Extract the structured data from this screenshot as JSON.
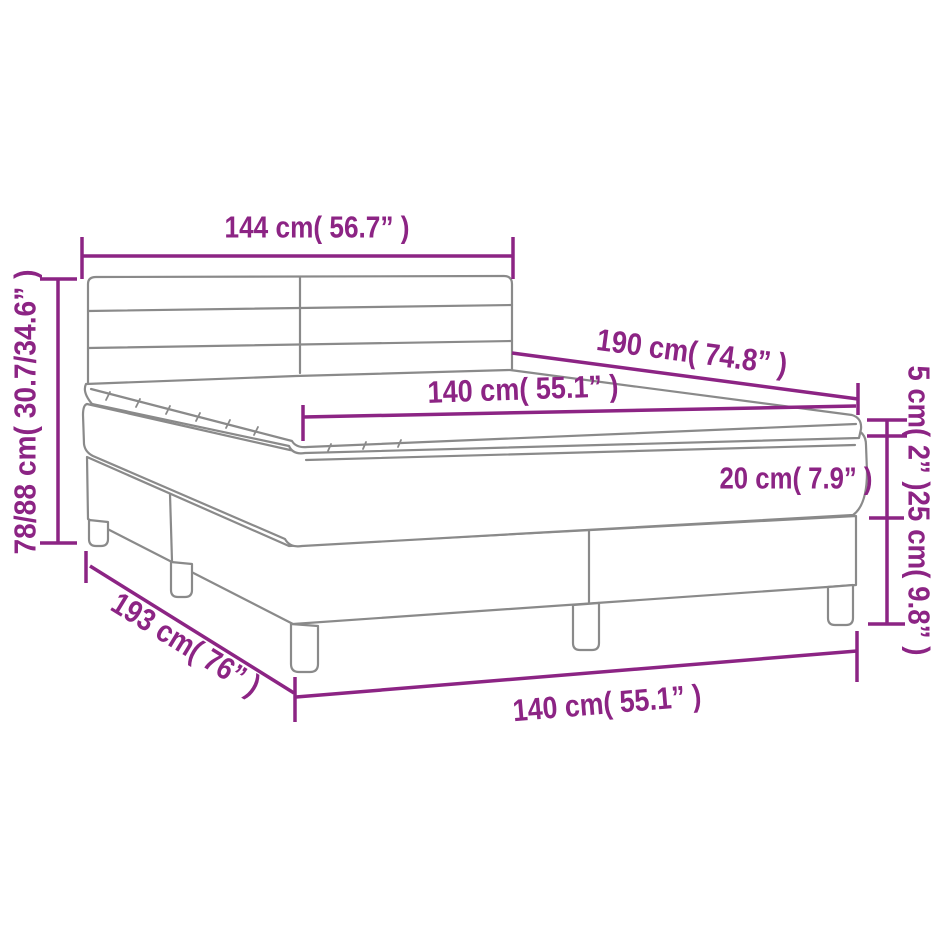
{
  "diagram": {
    "colors": {
      "dimension_accent": "#8c2484",
      "drawing_outline": "#8a8a8a",
      "background": "#ffffff"
    },
    "labels": {
      "headboard_width": "144 cm( 56.7” )",
      "overall_height": "78/88 cm( 30.7/34.6” )",
      "length": "190 cm( 74.8” )",
      "mattress_width": "140 cm( 55.1” )",
      "topper_height": "5 cm( 2” )",
      "mattress_height": "20 cm( 7.9” )",
      "base_height": "25 cm( 9.8” )",
      "base_length": "193 cm( 76” )",
      "base_width": "140 cm( 55.1” )"
    }
  }
}
